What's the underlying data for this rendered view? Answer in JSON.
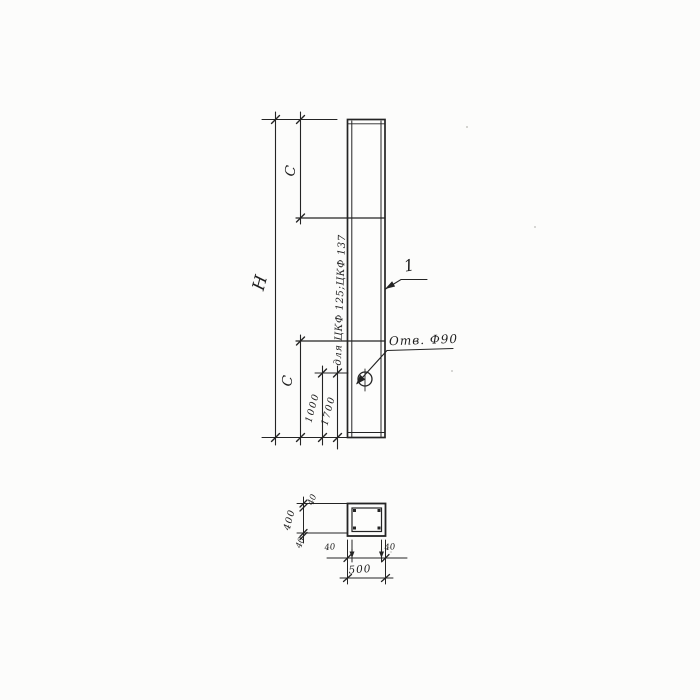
{
  "drawing": {
    "ink_color": "#242424",
    "paper_color": "#fcfcfb",
    "elevation": {
      "overall_height_label": "H",
      "upper_segment_label": "C",
      "lower_segment_label": "C",
      "hole_offset_dim": "1000",
      "hole_offset_alt_dim": "1700",
      "alt_applicability_note": "для ЦКФ 125;ЦКФ 137",
      "hole_callout": "Отв. Ф90",
      "item_number": "1"
    },
    "section": {
      "overall_width_dim": "500",
      "overall_height_dim": "400",
      "wall_thickness_top": "40",
      "wall_thickness_bottom": "40",
      "wall_thickness_left": "40",
      "wall_thickness_right": "40"
    }
  }
}
